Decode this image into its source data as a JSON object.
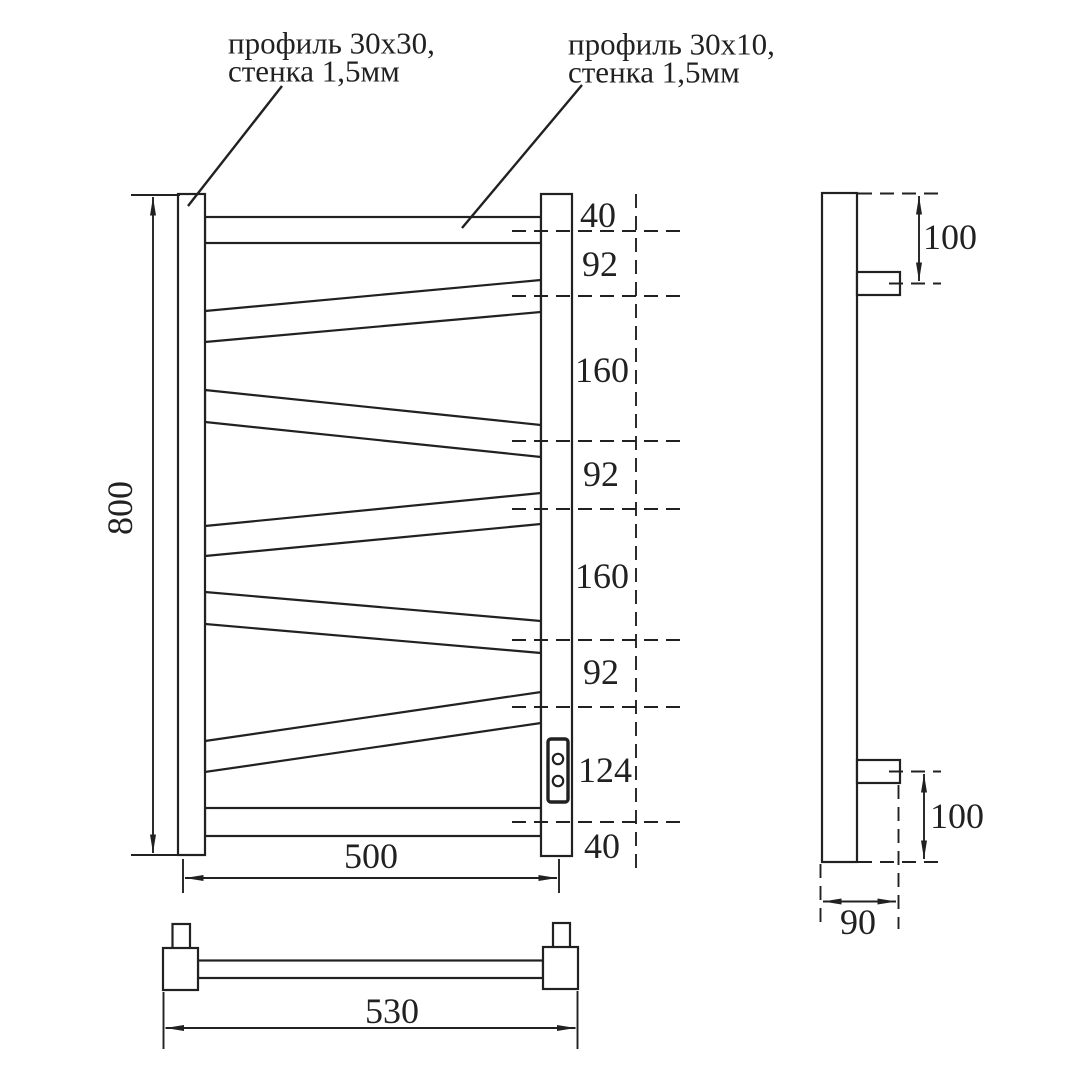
{
  "colors": {
    "line": "#212121",
    "background": "#ffffff"
  },
  "annotations": {
    "left_profile_label_line1": "профиль 30х30,",
    "left_profile_label_line2": "стенка 1,5мм",
    "right_profile_label_line1": "профиль 30х10,",
    "right_profile_label_line2": "стенка 1,5мм"
  },
  "front_view": {
    "overall_height": "800",
    "rail_width": "500",
    "segment_dims": [
      "40",
      "92",
      "160",
      "92",
      "160",
      "92",
      "124",
      "40"
    ]
  },
  "side_view": {
    "top_bracket_offset": "100",
    "bottom_bracket_offset": "100",
    "depth": "90"
  },
  "bottom_view": {
    "mount_width": "530"
  }
}
